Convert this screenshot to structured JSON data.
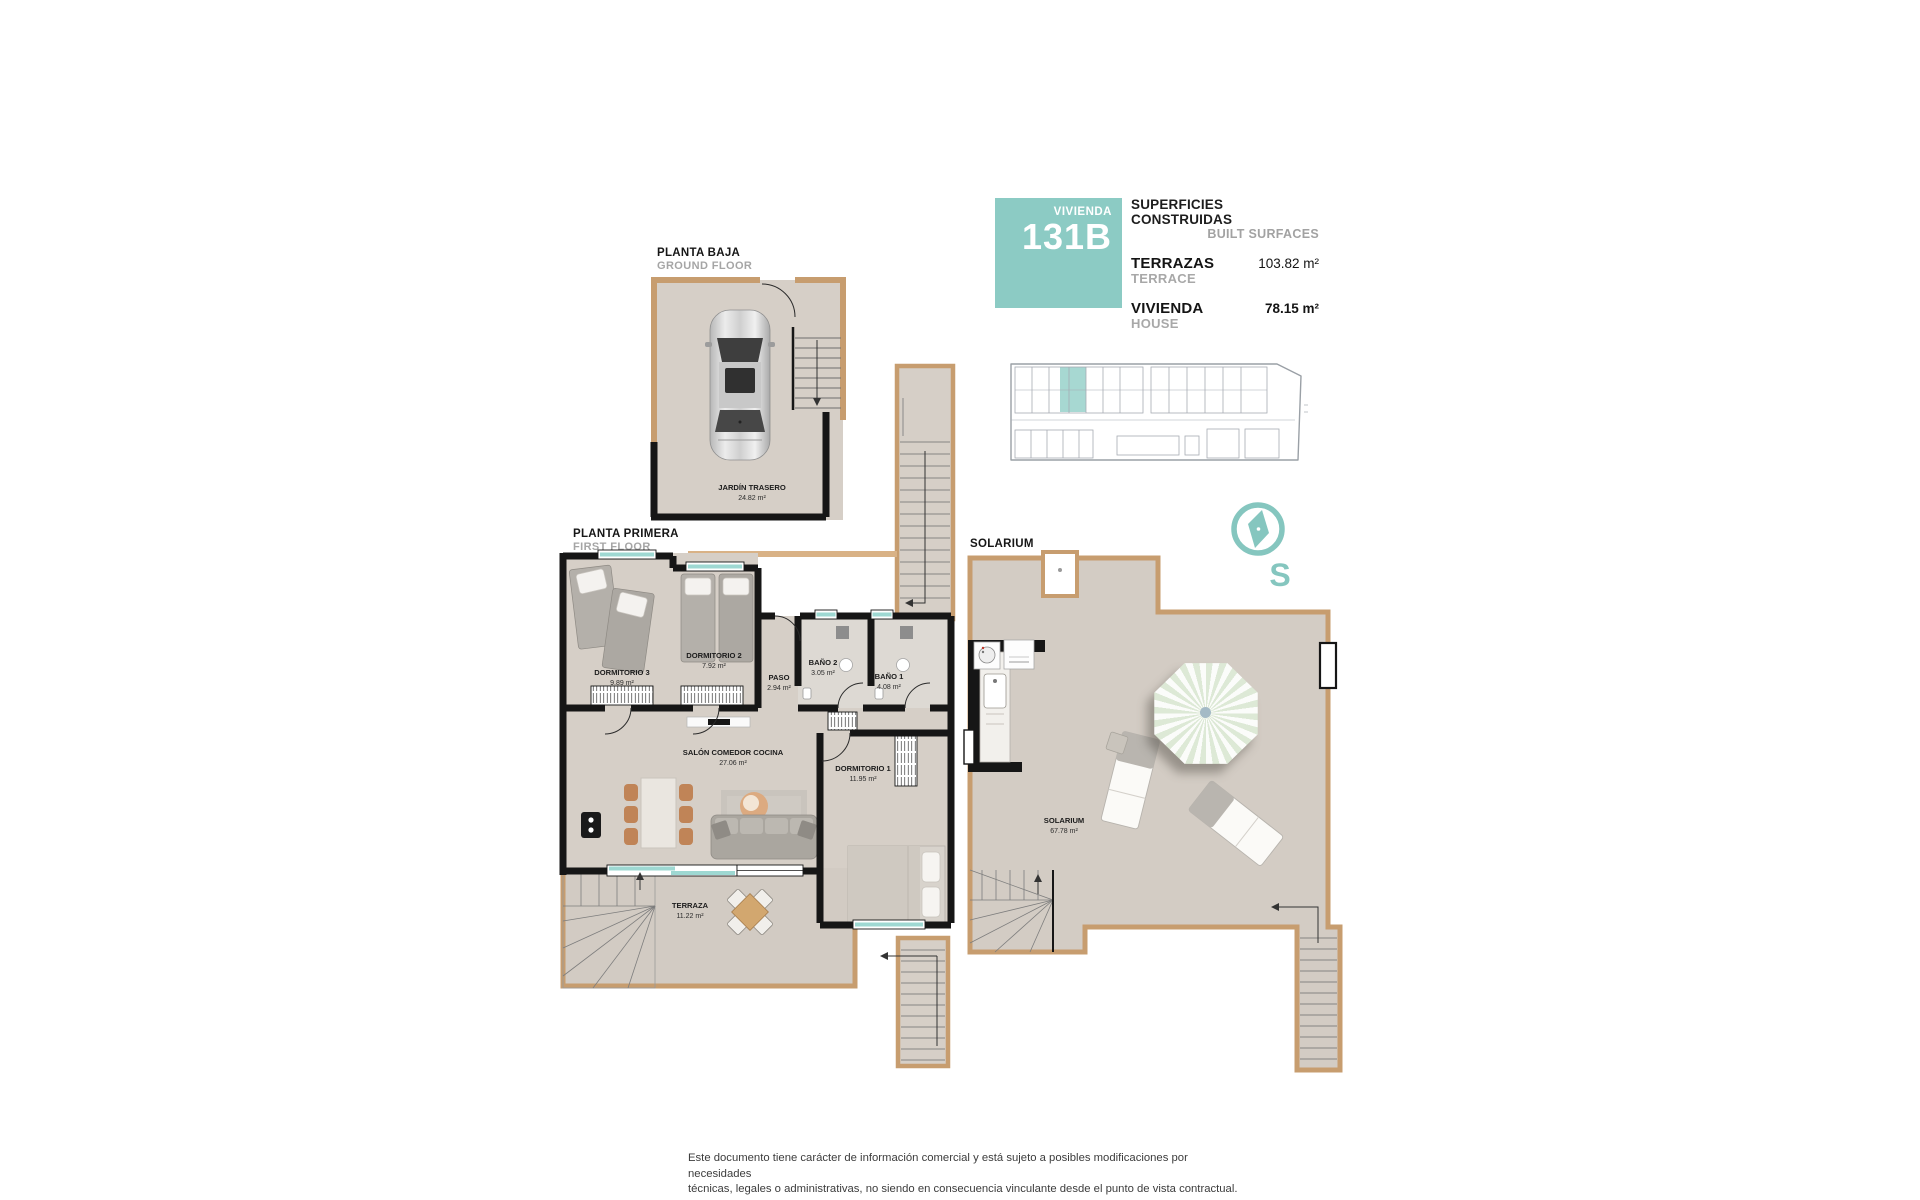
{
  "unit": {
    "badge_label": "VIVIENDA",
    "badge_number": "131B"
  },
  "surfaces": {
    "title_es": "SUPERFICIES CONSTRUIDAS",
    "title_en": "BUILT SURFACES",
    "rows": [
      {
        "label_es": "TERRAZAS",
        "label_en": "TERRACE",
        "value": "103.82 m²"
      },
      {
        "label_es": "VIVIENDA",
        "label_en": "HOUSE",
        "value": "78.15 m²"
      }
    ]
  },
  "floors": {
    "ground": {
      "title_es": "PLANTA BAJA",
      "title_en": "GROUND FLOOR",
      "rooms": [
        {
          "name": "JARDÍN TRASERO",
          "area": "24.82 m²"
        }
      ]
    },
    "first": {
      "title_es": "PLANTA PRIMERA",
      "title_en": "FIRST FLOOR",
      "rooms": [
        {
          "name": "DORMITORIO 3",
          "area": "9.89 m²"
        },
        {
          "name": "DORMITORIO 2",
          "area": "7.92 m²"
        },
        {
          "name": "PASO",
          "area": "2.94 m²"
        },
        {
          "name": "BAÑO 2",
          "area": "3.05 m²"
        },
        {
          "name": "BAÑO 1",
          "area": "4.08 m²"
        },
        {
          "name": "SALÓN COMEDOR COCINA",
          "area": "27.06 m²"
        },
        {
          "name": "DORMITORIO 1",
          "area": "11.95 m²"
        },
        {
          "name": "TERRAZA",
          "area": "11.22 m²"
        }
      ]
    },
    "solarium": {
      "title_es": "SOLARIUM",
      "rooms": [
        {
          "name": "SOLARIUM",
          "area": "67.78 m²"
        }
      ]
    }
  },
  "compass": {
    "letter": "S"
  },
  "footer": {
    "line1": "Este documento tiene carácter de información comercial y está sujeto a posibles modificaciones por necesidades",
    "line2": "técnicas, legales o administrativas, no siendo en consecuencia vinculante desde el punto de vista contractual."
  },
  "colors": {
    "accent_teal": "#8ccbc4",
    "window_teal": "#9ed8d2",
    "wall_black": "#161616",
    "floor_beige": "#d6cfc7",
    "wood_trim": "#c79d6f",
    "text_gray": "#a5a5a5"
  }
}
